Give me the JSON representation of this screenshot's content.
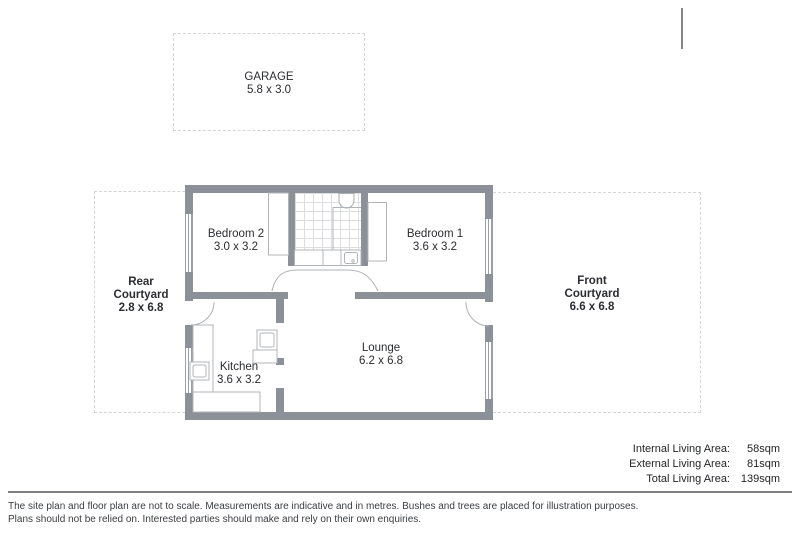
{
  "plan": {
    "rooms": {
      "garage": {
        "name": "GARAGE",
        "dims": "5.8 x 3.0"
      },
      "bedroom2": {
        "name": "Bedroom 2",
        "dims": "3.0 x 3.2"
      },
      "bedroom1": {
        "name": "Bedroom 1",
        "dims": "3.6 x 3.2"
      },
      "kitchen": {
        "name": "Kitchen",
        "dims": "3.6 x 3.2"
      },
      "lounge": {
        "name": "Lounge",
        "dims": "6.2 x 6.8"
      }
    },
    "courtyards": {
      "rear": {
        "line1": "Rear",
        "line2": "Courtyard",
        "dims": "2.8 x 6.8"
      },
      "front": {
        "line1": "Front",
        "line2": "Courtyard",
        "dims": "6.6 x 6.8"
      }
    }
  },
  "areas": {
    "internal": {
      "label": "Internal Living Area:",
      "value": "58sqm"
    },
    "external": {
      "label": "External Living Area:",
      "value": "81sqm"
    },
    "total": {
      "label": "Total Living Area:",
      "value": "139sqm"
    }
  },
  "disclaimer": {
    "line1": "The site plan and floor plan are not to scale. Measurements are indicative and in metres. Bushes and trees are placed for illustration purposes.",
    "line2": "Plans should not be relied on. Interested parties should make and rely on their own enquiries."
  },
  "colors": {
    "wall": "#8c9199",
    "fixture_line": "#b0b4ba",
    "tile_line": "#dcdee0",
    "dashed_border": "#d3d5d7",
    "text": "#2b2d31",
    "rule": "#7d7f83"
  }
}
